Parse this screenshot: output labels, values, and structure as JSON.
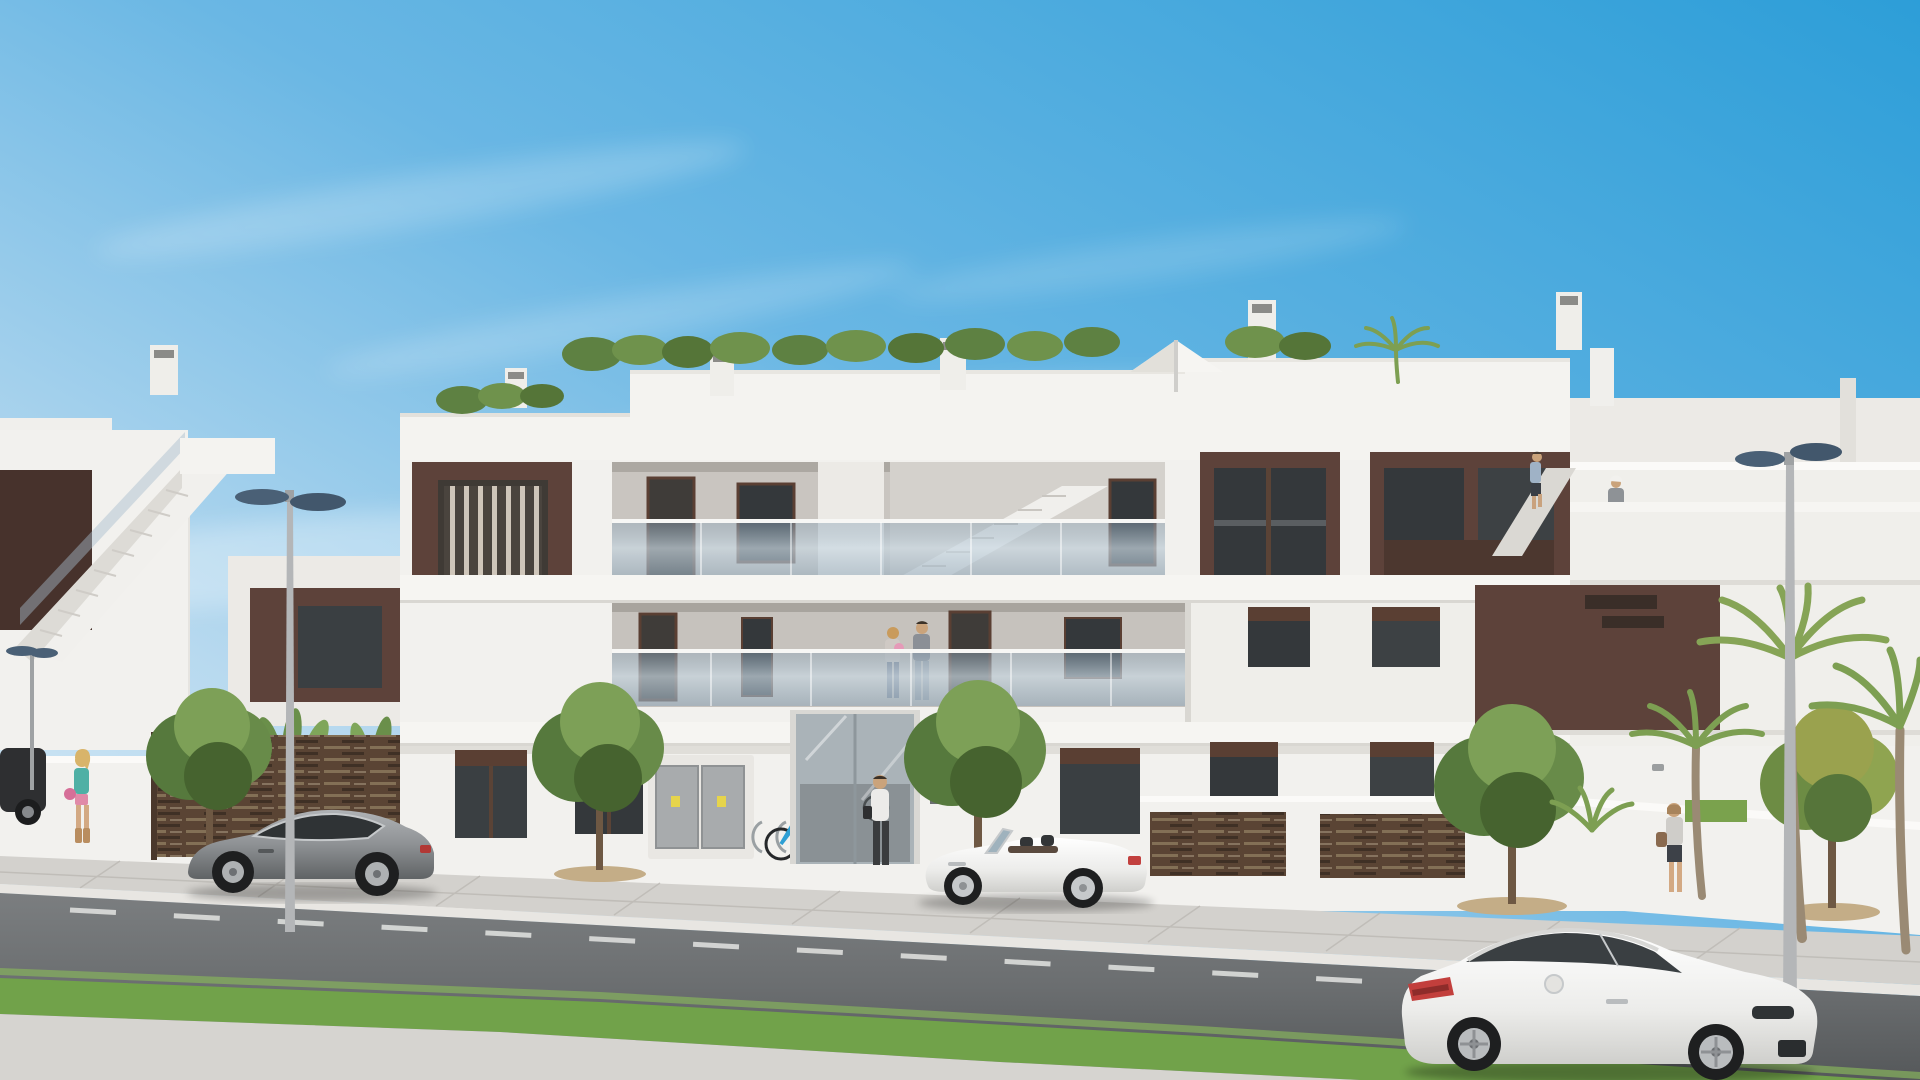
{
  "meta": {
    "type": "architectural-3d-render",
    "description": "Photorealistic render of a modern white three-storey apartment building with dark brown facade panels, glass balustrade balconies, rooftop greenery, street with parked and passing cars, pedestrians, ornamental trees and palms under a clear blue sky",
    "width_px": 1920,
    "height_px": 1080
  },
  "palette": {
    "sky_top": "#2d9ed8",
    "sky_mid": "#6ab7e4",
    "sky_horizon": "#e2f0f8",
    "wall_white": "#f2f1ee",
    "wall_shadow": "#d9d7d2",
    "interior_wall": "#c6c2bd",
    "brown_panel": "#5d423a",
    "brown_dark": "#47322c",
    "window_glass": "#3a3f42",
    "balcony_glass": "#a7bccb",
    "road_asphalt": "#6e7173",
    "sidewalk": "#d3d1cd",
    "grass": "#71a24a",
    "tree_green": "#56793d",
    "palm_green": "#7d9f52",
    "lamp_head": "#4a6076",
    "car_grey": "#909396",
    "car_white": "#f3f3f1",
    "tail_light_red": "#c23f3c",
    "bike_blue": "#2e9fd4",
    "warning_label_yellow": "#e6d44c"
  },
  "scene": {
    "sky": {
      "condition": "clear with thin wispy clouds",
      "gradient": "deep blue upper-right to pale blue-white at horizon"
    },
    "buildings": {
      "storeys": 3,
      "style": "modern flat-roof white render with dark brown accent panels",
      "features": [
        "rooftop hedge planting and small palm",
        "white parasol on roof terrace",
        "roof chimney vents",
        "glass balustrade balconies on two upper floors",
        "internal staircase visible behind glass on top floor",
        "external white staircase on left neighbouring block",
        "external staircase on right wing with person climbing",
        "dark brown window and door frames",
        "ground floor entrance with glass doors",
        "grey utility cabinet with two doors and yellow warning labels",
        "bicycle rack with blue bicycle",
        "brown horizontal-slat garden fences and gate",
        "white garden walls with ornamental planting"
      ]
    },
    "vehicles": [
      {
        "name": "grey-sports-coupe",
        "position": "parked left, facing left",
        "color": "metallic grey"
      },
      {
        "name": "white-convertible",
        "position": "centre road, top down, facing left",
        "color": "white"
      },
      {
        "name": "white-coupe-foreground",
        "position": "bottom right foreground, facing right",
        "color": "white"
      },
      {
        "name": "dark-car-glimpse",
        "position": "far left behind garden wall",
        "color": "dark grey"
      }
    ],
    "people": [
      {
        "name": "balcony-couple-with-baby",
        "position": "first-floor balcony centre"
      },
      {
        "name": "man-at-entrance",
        "position": "walking toward glass entrance, white shirt, dark trousers, bag"
      },
      {
        "name": "woman-walking-left",
        "position": "left sidewalk, teal top, pink shorts, tan boots, pink bag"
      },
      {
        "name": "woman-walking-right",
        "position": "right sidewalk, light top, dark skirt, brown bag"
      },
      {
        "name": "person-climbing-right-stairs",
        "position": "right wing external stair"
      },
      {
        "name": "person-on-roof-terrace",
        "position": "right roof terrace, white cap"
      }
    ],
    "vegetation": [
      "five ornamental street trees in sidewalk pits",
      "two tall palms at right",
      "palm cluster at far right edge",
      "small palm shrub behind right garden wall",
      "banana-leaf plants behind left garden walls",
      "rooftop hedge row"
    ],
    "street": {
      "elements": [
        "light grey paved sidewalk with joint lines",
        "dark asphalt road with dashed white lane markings",
        "green grass median strip",
        "pale foreground pavement",
        "two tall double-headed street lamps",
        "small distant street lamp at far left"
      ]
    }
  }
}
